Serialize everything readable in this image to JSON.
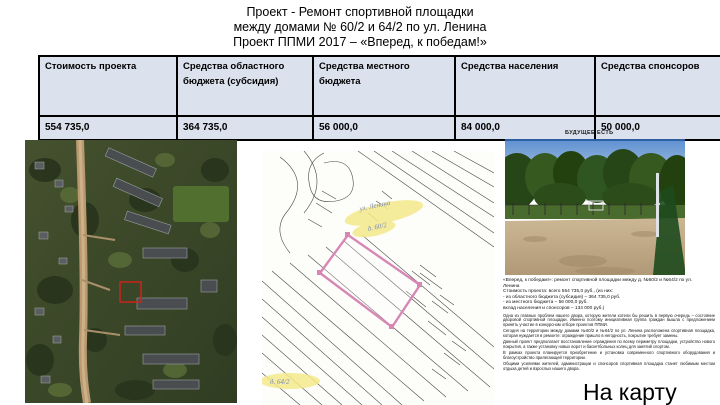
{
  "slide": {
    "title_lines": [
      "Проект  - Ремонт спортивной площадки",
      "между домами  № 60/2 и 64/2 по ул. Ленина",
      "Проект ППМИ 2017 – «Вперед, к победам!»"
    ],
    "table": {
      "headers": [
        "Стоимость проекта",
        "Средства областного бюджета (субсидия)",
        "Средства местного бюджета",
        "Средства населения",
        "Средства спонсоров"
      ],
      "values": [
        "554 735,0",
        "364 735,0",
        "56 000,0",
        "84 000,0",
        "50 000,0"
      ]
    },
    "future_label": "БУДУЩЕЕ ЕСТЬ",
    "plan_annotations": {
      "street": "ул. Ленина",
      "house_top": "д. 60/2",
      "house_bottom": "д. 64/2"
    },
    "description": {
      "head_lines": [
        "«Вперед, к победам!»: ремонт спортивной площадки между д. №60/2 и №64/2 по ул.",
        "Ленина",
        "Стоимость проекта: всего 554 735,0 руб., (из них:",
        "- из областного бюджета (субсидия) – 364 735,0 руб.",
        "- из местного бюджета – 56 000,0 руб.",
        "вклад населения и спонсоров – 134 000 руб.)"
      ],
      "paragraphs": [
        "Одна из главных проблем нашего двора, которую жители хотели бы решить в первую очередь – состояние дворовой спортивной площадки. Именно поэтому инициативная группа граждан вышла с предложением принять участие в конкурсном отборе проектов ППМИ.",
        "Сегодня на территории между домами №60/2 и №64/2 по ул. Ленина расположена спортивная площадка, которая нуждается в ремонте: ограждение пришло в негодность, покрытие требует замены.",
        "Данный проект предполагает восстановление ограждения по всему периметру площадки, устройство нового покрытия, а также установку новых ворот и баскетбольных колец для занятий спортом.",
        "В рамках проекта планируется приобретение и установка современного спортивного оборудования и благоустройство прилегающей территории.",
        "Общими усилиями жителей, администрации и спонсоров спортивная площадка станет любимым местом отдыха детей и взрослых нашего двора."
      ]
    },
    "map_link_label": "На карту"
  },
  "colors": {
    "table_bg": "#dbe1ed",
    "site_outline_red": "#c1271b",
    "plan_outline_pink": "#d887b5",
    "highlight_yellow": "#f3ea8a"
  }
}
